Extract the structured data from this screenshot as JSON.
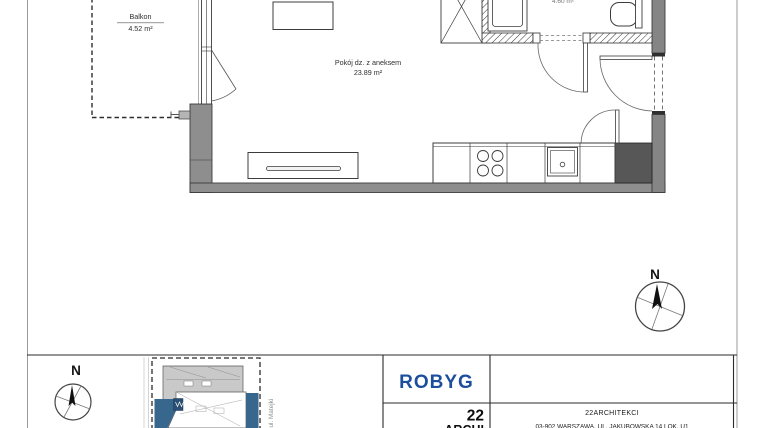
{
  "plan": {
    "balcony_label": "Balkon",
    "balcony_area": "4.52 m²",
    "room_label": "Pokój dz. z aneksem",
    "room_area": "23.89 m²",
    "bath_area_partial": "4.60 m²"
  },
  "compass": {
    "north": "N"
  },
  "siteplan": {
    "street": "ul. Matejki",
    "north": "N"
  },
  "titleblock": {
    "developer_logo": "ROBYG",
    "architect_logo_top": "22",
    "architect_logo_bottom": "ARCHI",
    "architect_name": "22ARCHITEKCI",
    "architect_address": "03-902 WARSZAWA, UL. JAKUBOWSKA 14 LOK. U1"
  },
  "colors": {
    "brand_blue": "#1b4f9e",
    "site_blue": "#38678e",
    "wall_gray": "#8e8e8e"
  }
}
